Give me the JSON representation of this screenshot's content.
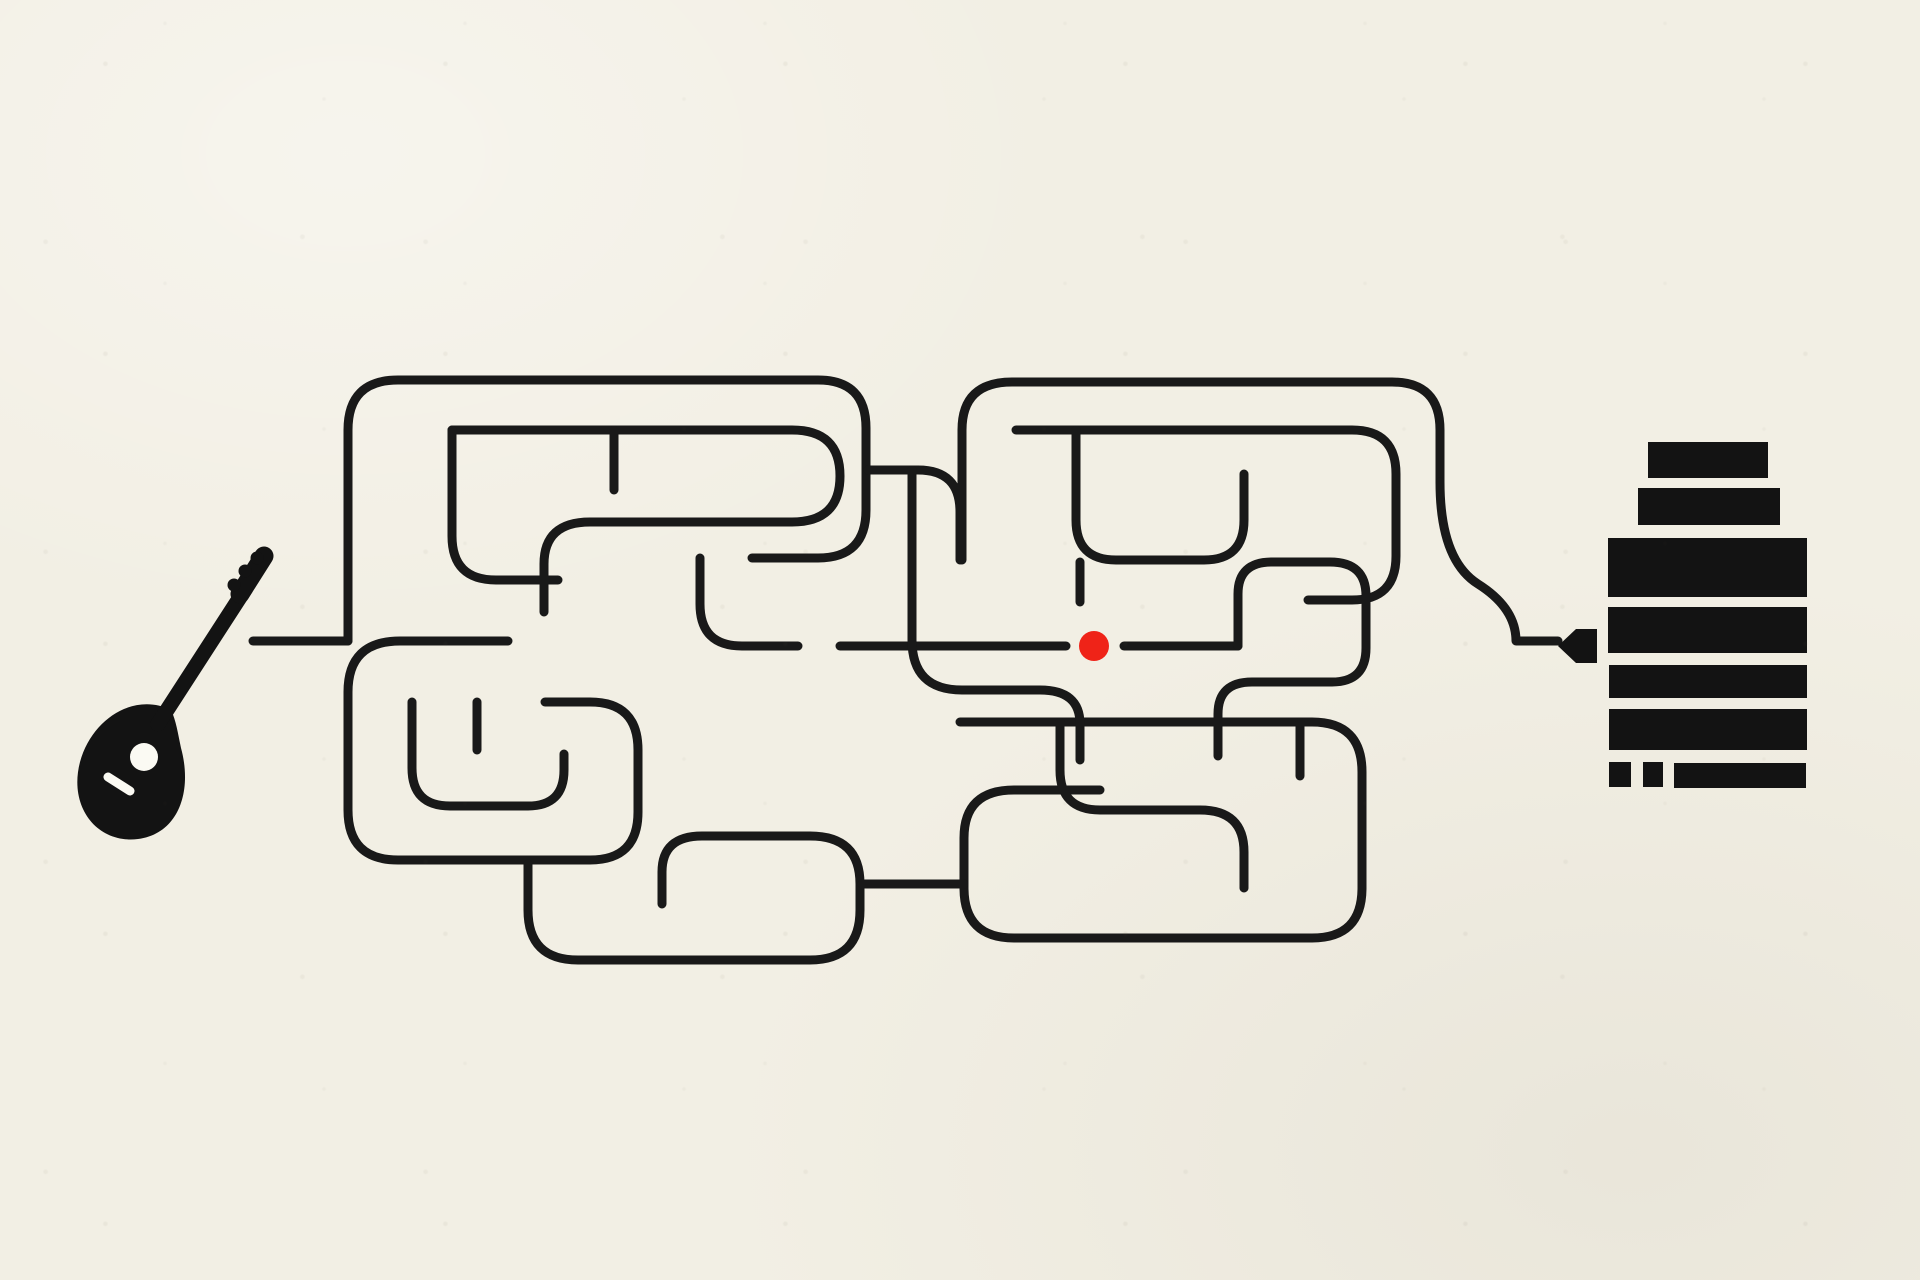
{
  "colors": {
    "background": "#f2efe4",
    "line": "#191919",
    "ink": "#131313",
    "accent": "#ef2318",
    "paper": "#fbfaf3"
  },
  "objects": {
    "left_icon": "lute-instrument",
    "right_icon": "amplifier-speaker-stack",
    "connector_icon": "power-plug",
    "marker": "red-dot"
  },
  "maze": {
    "stroke_width": 9,
    "dot": {
      "cx": 1094,
      "cy": 646,
      "r": 15
    },
    "paths": [
      "M253 641 H348",
      "M348 641 V430 Q348 380 398 380 H818 Q866 380 866 428 V510 Q866 558 818 558 H752",
      "M452 430 H792 Q840 430 840 476 Q840 522 792 522 H590 Q544 522 544 564 V612",
      "M452 430 V536 Q452 580 496 580 H558",
      "M614 430 V490",
      "M508 641 H400 Q348 641 348 692 V810 Q348 860 398 860 H590 Q638 860 638 812 V750 Q638 702 590 702 H545",
      "M412 702 V768 Q412 806 450 806 H528 Q564 806 564 770 V754",
      "M477 702 V750",
      "M528 864 V910 Q528 960 578 960 H810 Q860 960 860 910 V884 Q860 836 810 836 H702 Q662 836 662 872 V904",
      "M700 558 V604 Q700 646 742 646 H798",
      "M868 470 H918 Q960 470 960 512 V560",
      "M962 560 V430 Q962 382 1012 382 H1392 Q1440 382 1440 430 V482",
      "M1016 430 H1352 Q1396 430 1396 474 V556 Q1396 600 1352 600 H1308",
      "M1076 430 V520 Q1076 560 1116 560 H1204 Q1244 560 1244 520 V474",
      "M840 646 H1066",
      "M1124 646 H1238",
      "M1080 562 V602",
      "M1238 646 V594 Q1238 562 1272 562 H1330 Q1366 562 1366 596 V648 Q1366 682 1332 682 H1252 Q1218 682 1218 714 V756",
      "M960 722 H1312 Q1362 722 1362 772 V888 Q1362 938 1312 938 H1014 Q964 938 964 888 V838 Q964 790 1014 790 H1100",
      "M1060 722 V770 Q1060 810 1100 810 H1200 Q1244 810 1244 852 V888",
      "M912 470 V640 Q912 690 962 690 H1040 Q1080 690 1080 724 V760",
      "M862 884 H964",
      "M1440 482 Q1440 560 1478 584 Q1516 608 1516 641 H1558",
      "M1300 722 V776"
    ]
  },
  "amplifier": {
    "bars": [
      {
        "x": 1648,
        "y": 442,
        "w": 120,
        "h": 36
      },
      {
        "x": 1638,
        "y": 488,
        "w": 142,
        "h": 37
      },
      {
        "x": 1608,
        "y": 538,
        "w": 199,
        "h": 59
      },
      {
        "x": 1608,
        "y": 607,
        "w": 199,
        "h": 46
      },
      {
        "x": 1609,
        "y": 665,
        "w": 198,
        "h": 33
      },
      {
        "x": 1609,
        "y": 709,
        "w": 198,
        "h": 41
      },
      {
        "x": 1609,
        "y": 762,
        "w": 22,
        "h": 25
      },
      {
        "x": 1643,
        "y": 762,
        "w": 20,
        "h": 25
      },
      {
        "x": 1674,
        "y": 763,
        "w": 132,
        "h": 25
      }
    ]
  }
}
